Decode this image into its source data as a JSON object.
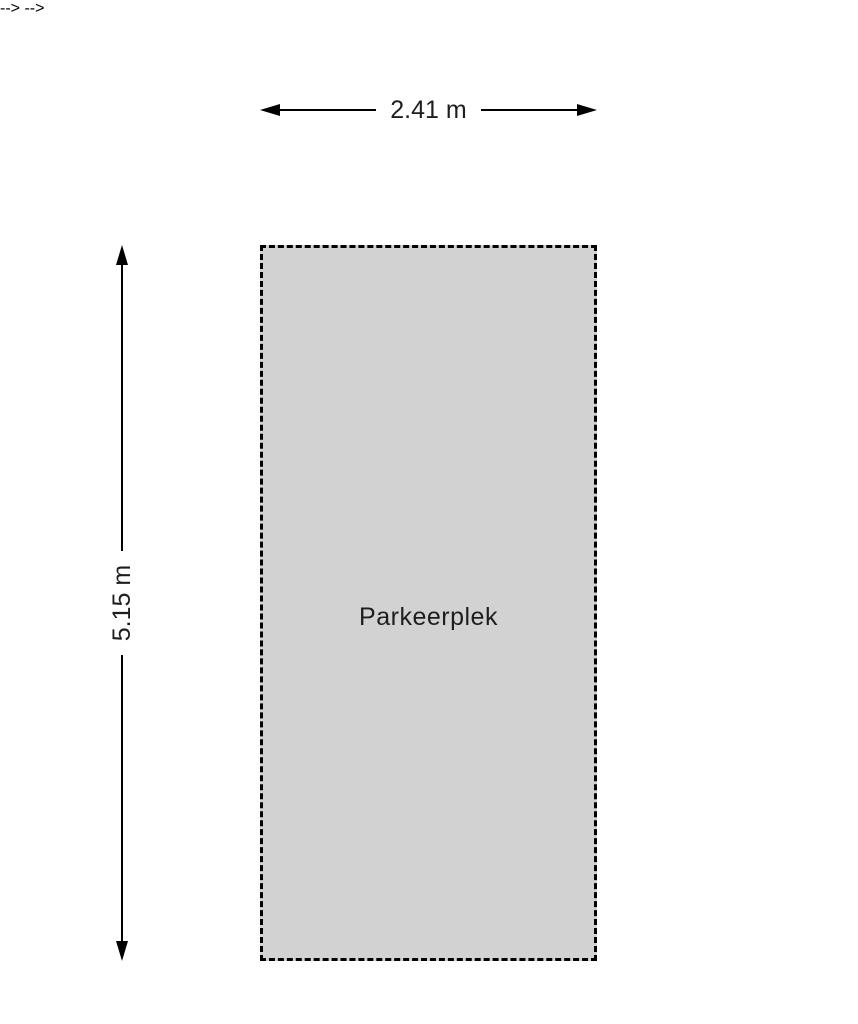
{
  "diagram": {
    "title": "Parkeerplek floor plan",
    "room": {
      "label": "Parkeerplek"
    },
    "dimensions": {
      "width": "2.41 m",
      "height": "5.15 m"
    }
  },
  "colors": {
    "background": "#ffffff",
    "room_fill": "#d2d2d2",
    "line": "#000000",
    "text": "#1e1e1e"
  }
}
